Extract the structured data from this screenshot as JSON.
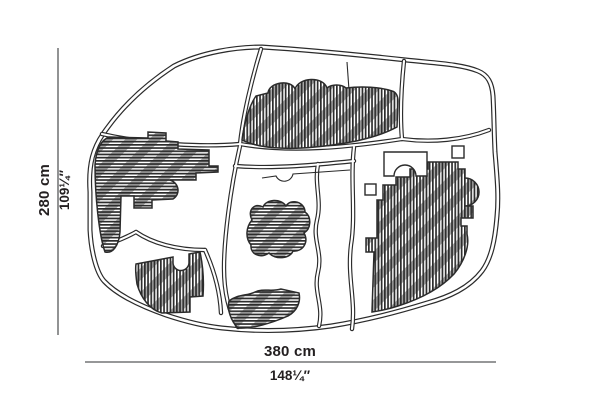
{
  "figure": {
    "kind": "top-view dimension diagram of an irregular modular composition with hatched elements"
  },
  "dimensions": {
    "height_cm": "280 cm",
    "height_in": "109¼″",
    "width_cm": "380 cm",
    "width_in": "148¼″"
  },
  "colors": {
    "ink": "#2b2b2b",
    "dimension_line": "#58595b",
    "label": "#231f20",
    "background": "#ffffff"
  }
}
